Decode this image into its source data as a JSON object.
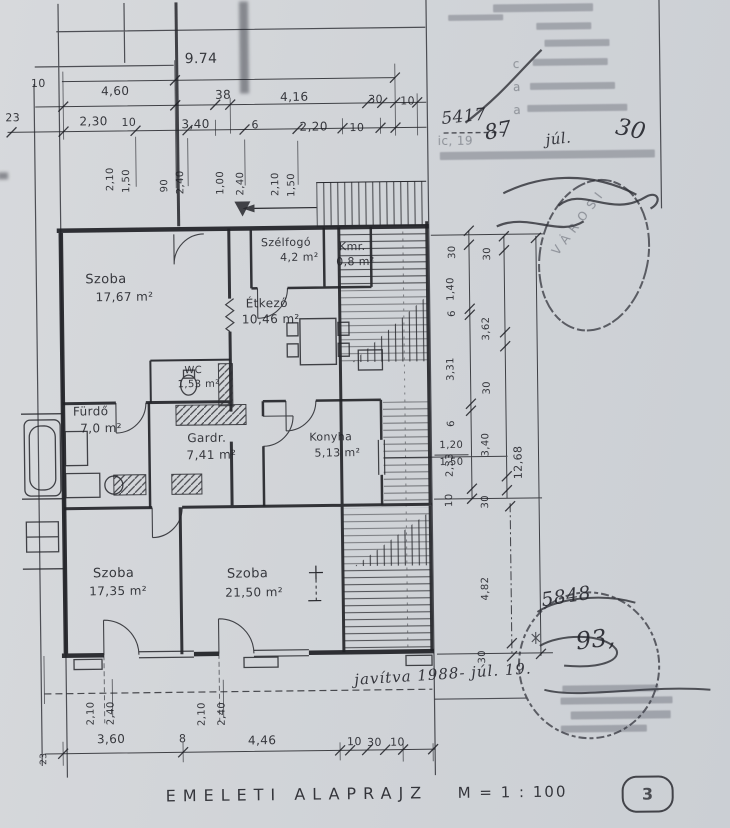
{
  "sheet": {
    "title": "EMELETI  ALAPRAJZ",
    "scale": "M = 1 : 100",
    "number": "3"
  },
  "rooms": [
    {
      "name": "Szoba",
      "area": "17,67 m²"
    },
    {
      "name": "Szélfogó",
      "area": "4,2 m²"
    },
    {
      "name": "Kmr.",
      "area": "0,8 m²"
    },
    {
      "name": "Étkező",
      "area": "10,46 m²"
    },
    {
      "name": "WC",
      "area": "1,53 m²"
    },
    {
      "name": "Fürdő",
      "area": "7,0 m²"
    },
    {
      "name": "Gardr.",
      "area": "7,41 m²"
    },
    {
      "name": "Konyha",
      "area": "5,13 m²"
    },
    {
      "name": "Szoba",
      "area": "17,35 m²"
    },
    {
      "name": "Szoba",
      "area": "21,50 m²"
    }
  ],
  "dims": {
    "t1a": "10",
    "t1b": "9.74",
    "t2": [
      "4,60",
      "38",
      "4,16",
      "30",
      "10"
    ],
    "t3": [
      "23",
      "2,30",
      "10",
      "3,40",
      "6",
      "2,20",
      "10"
    ],
    "tv": [
      "2,10",
      "1,50",
      "90",
      "2,40",
      "1,00",
      "2,40",
      "2,10",
      "1,50"
    ],
    "ra": [
      "30",
      "1,40",
      "6",
      "3,31",
      "6",
      "2,33",
      "10"
    ],
    "rb": [
      "30",
      "3,62",
      "30",
      "3,40",
      "30"
    ],
    "rtotal": "12,68",
    "win_top": "1,20",
    "win_bot": "1,50",
    "r_lower": [
      "4,82",
      "30"
    ],
    "b1": [
      "23",
      "3,60",
      "8",
      "4,46",
      "10",
      "30",
      "10"
    ],
    "door_pairs": [
      "2,10",
      "2,40",
      "2,10",
      "2,40"
    ]
  },
  "annotations": {
    "number": "5417",
    "typed_date_prefix": "ic, 19",
    "hand_year": "87",
    "hand_month": "júl.",
    "hand_day": "30",
    "margin_letters": [
      "c",
      "a",
      "a"
    ],
    "stamp_top_word": "VÁROSI",
    "hand_number_1": "5848",
    "hand_number_2": "93,",
    "revision_note": "javítva 1988- júl. 19."
  }
}
